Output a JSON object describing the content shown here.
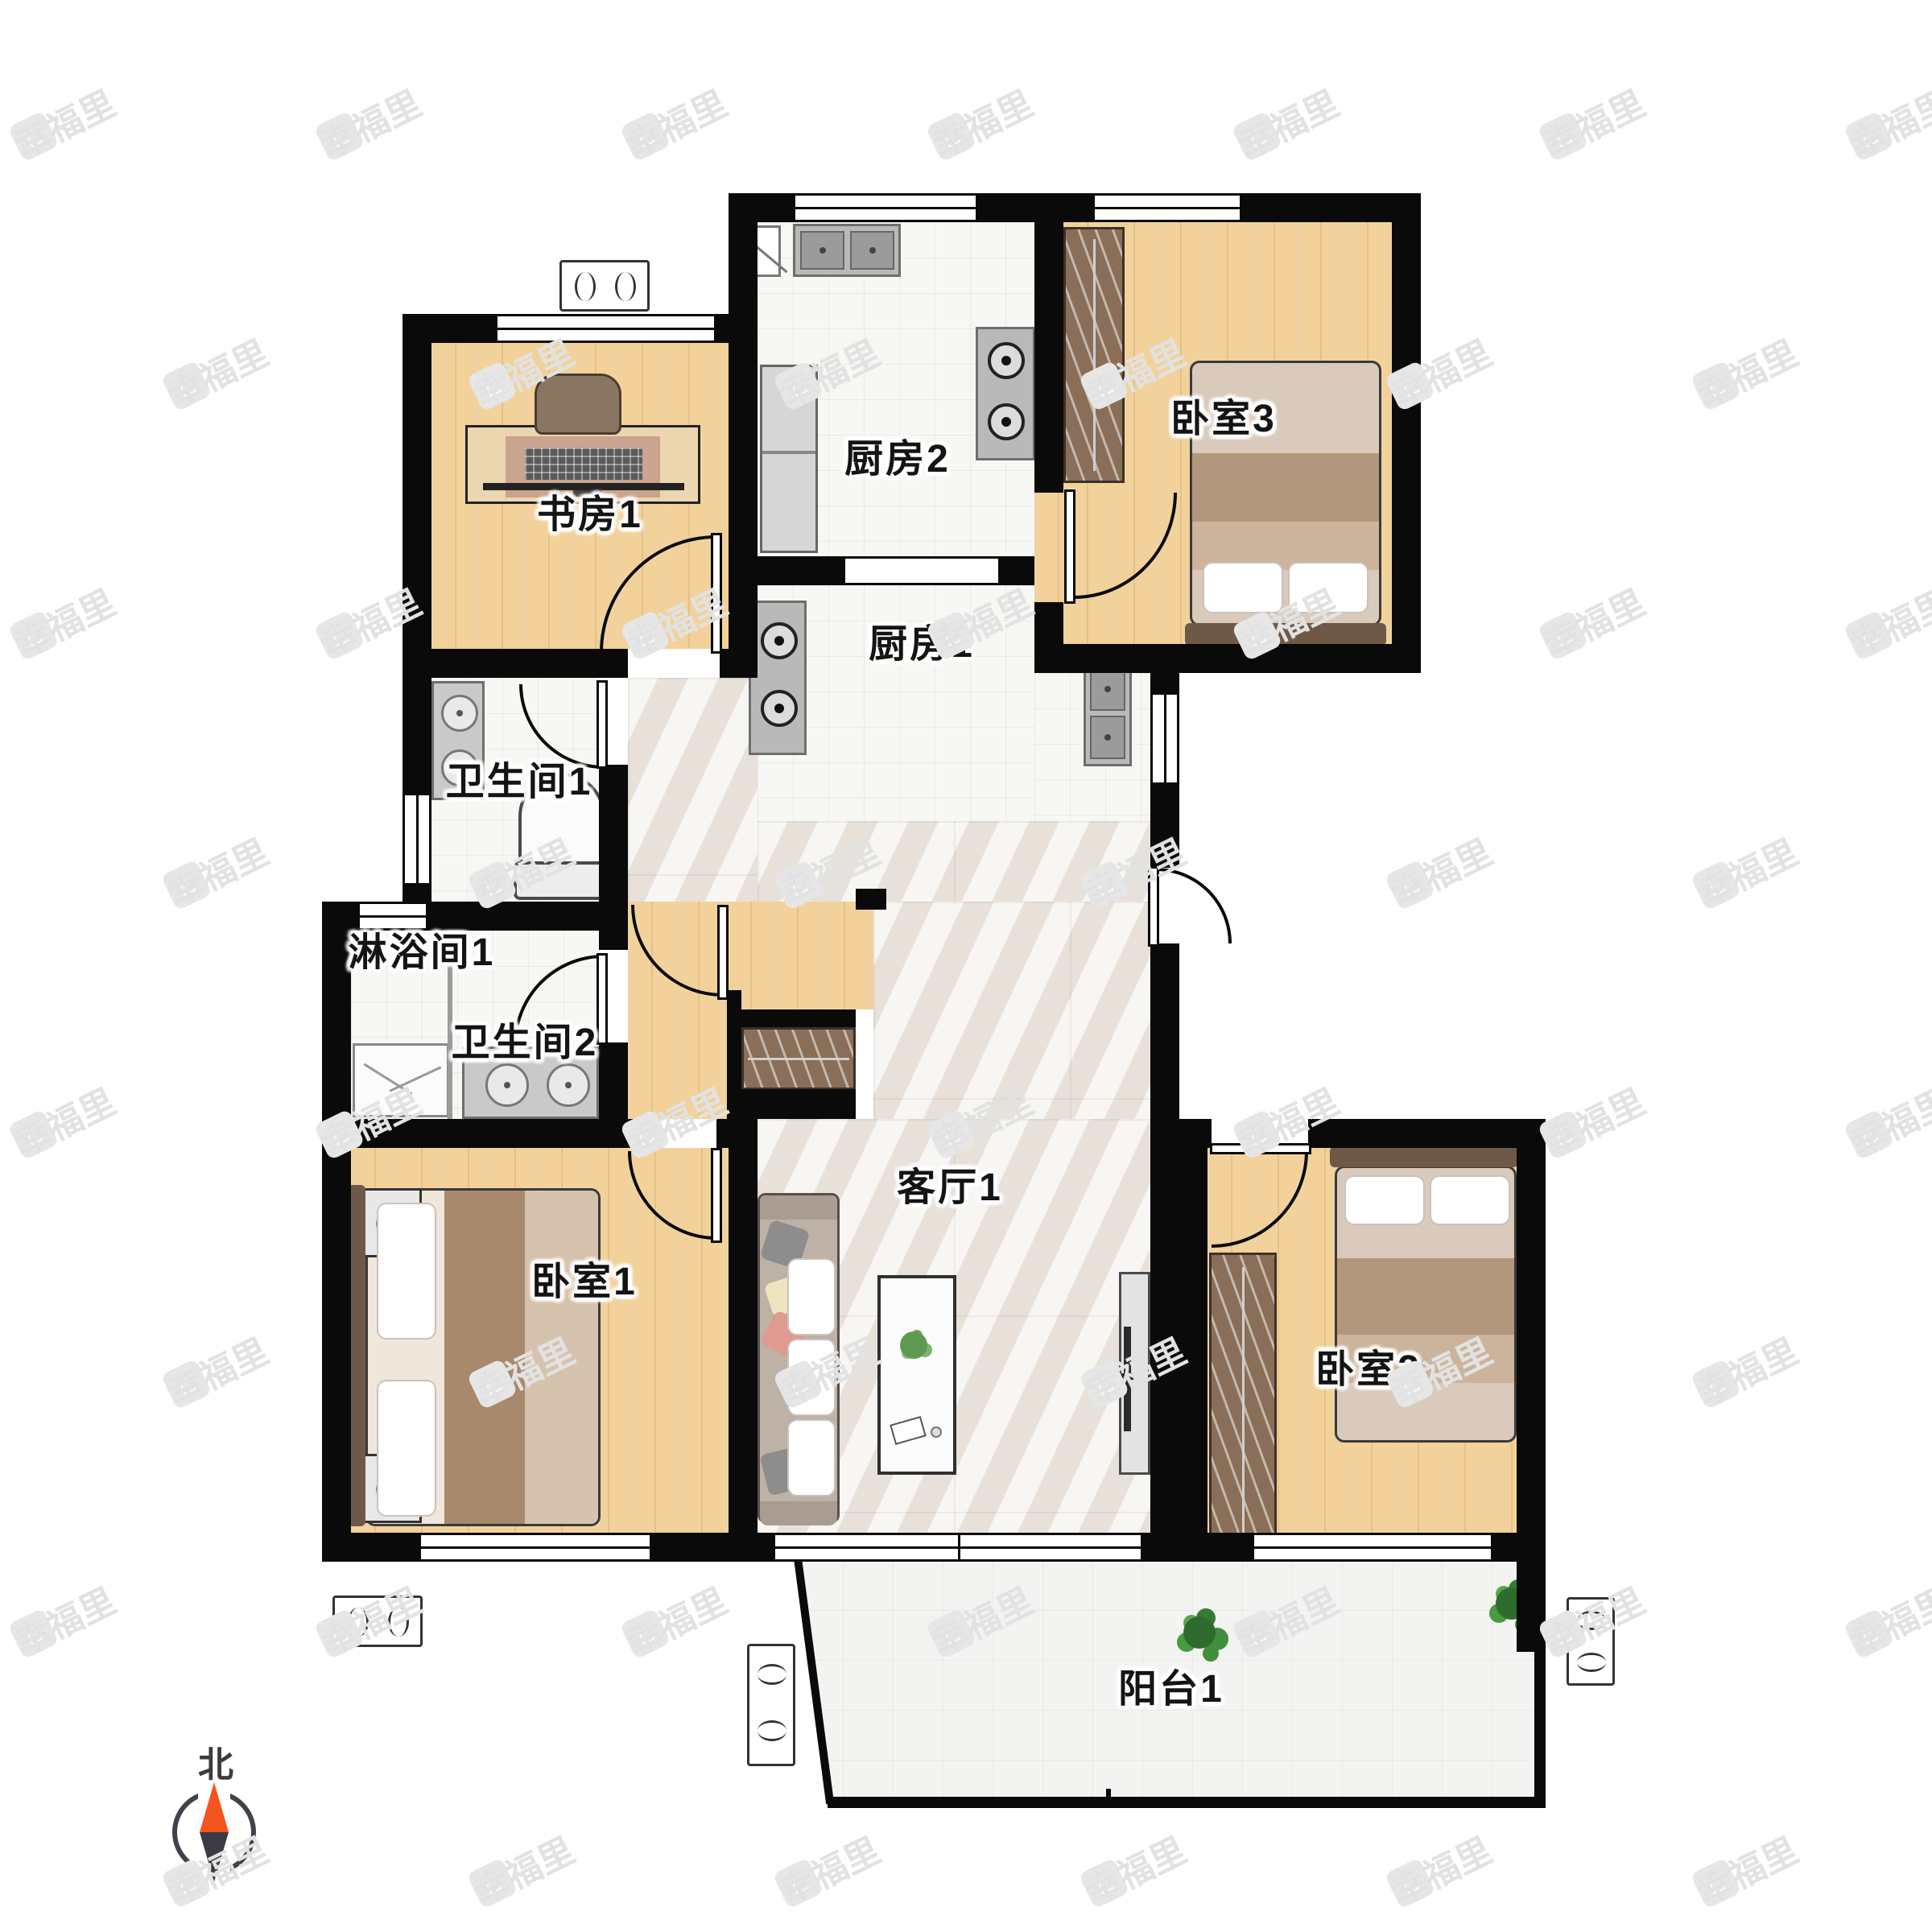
{
  "watermark": {
    "text": "幸福里",
    "icon": "house-icon"
  },
  "compass": {
    "label": "北",
    "icon": "compass-needle-icon",
    "north_color": "#f4551c",
    "south_color": "#3b3b44"
  },
  "rooms": [
    {
      "id": "kitchen-2",
      "label": "厨房2"
    },
    {
      "id": "bedroom-3",
      "label": "卧室3"
    },
    {
      "id": "study-1",
      "label": "书房1"
    },
    {
      "id": "kitchen-1",
      "label": "厨房1"
    },
    {
      "id": "bathroom-1",
      "label": "卫生间1"
    },
    {
      "id": "shower-1",
      "label": "淋浴间1"
    },
    {
      "id": "bathroom-2",
      "label": "卫生间2"
    },
    {
      "id": "bedroom-1",
      "label": "卧室1"
    },
    {
      "id": "living-1",
      "label": "客厅1"
    },
    {
      "id": "bedroom-2",
      "label": "卧室2"
    },
    {
      "id": "balcony-1",
      "label": "阳台1"
    }
  ],
  "colors": {
    "wall": "#0a0a0a",
    "wood_floor": "#f2d29a",
    "tile_floor": "#f7f7f4",
    "marble_floor": "#efeae4",
    "wardrobe": "#8a6e57",
    "bed_blanket": "#b2977d",
    "accent_orange": "#f4551c",
    "needle_dark": "#3b3b44"
  }
}
